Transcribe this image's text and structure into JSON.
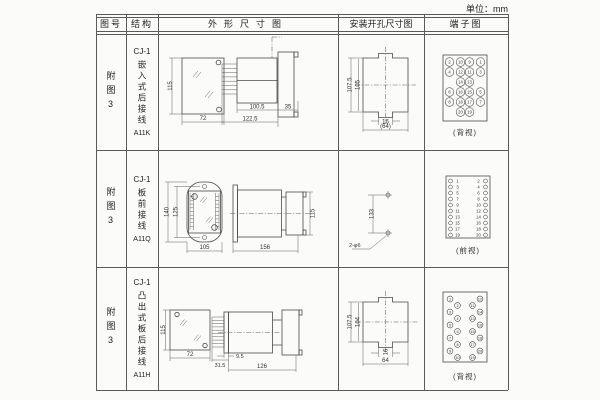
{
  "unit_note": "单位：mm",
  "colors": {
    "line": "#4a4a4a",
    "text": "#333333",
    "paper": "#fbfbf9"
  },
  "table": {
    "headers": [
      "图号",
      "结构",
      "外形尺寸图",
      "安装开孔尺寸图",
      "端子图"
    ],
    "rows": [
      {
        "fig_no": "附图3",
        "structure": {
          "model": "CJ-1",
          "mount": "嵌入式后接线",
          "code": "A11K"
        },
        "outline_dims": {
          "height": "115",
          "width": "72",
          "depth": "100.5",
          "total_depth": "122.5",
          "flange": "35"
        },
        "install_dims": {
          "outer": "107.5",
          "inner": "105",
          "notch": "16",
          "width": "(64)"
        },
        "terminal": {
          "view_label": "(背视)",
          "rows": [
            [
              "2",
              "10",
              "9",
              "1"
            ],
            [
              "4",
              "12",
              "11",
              "3"
            ],
            [
              "",
              "14",
              "13",
              ""
            ],
            [
              "6",
              "16",
              "15",
              "5"
            ],
            [
              "8",
              "18",
              "17",
              "7"
            ],
            [
              "",
              "20",
              "19",
              ""
            ]
          ]
        }
      },
      {
        "fig_no": "附图3",
        "structure": {
          "model": "CJ-1",
          "mount": "板前接线",
          "code": "A11Q"
        },
        "outline_dims": {
          "height": "140",
          "hole_span": "125",
          "width": "105",
          "length": "156",
          "rear_height": "115"
        },
        "install_dims": {
          "spacing": "133",
          "holes": "2-φ6"
        },
        "terminal": {
          "view_label": "(前视)",
          "left": [
            "1",
            "3",
            "5",
            "7",
            "9",
            "11",
            "13",
            "15",
            "17",
            "19"
          ],
          "right": [
            "2",
            "4",
            "6",
            "8",
            "10",
            "12",
            "14",
            "16",
            "18",
            "20"
          ]
        }
      },
      {
        "fig_no": "附图3",
        "structure": {
          "model": "CJ-1",
          "mount": "凸出式板后接线",
          "code": "A11H"
        },
        "outline_dims": {
          "height": "115",
          "width": "72",
          "fins_depth": "31.5",
          "plate": "9.5",
          "length": "126"
        },
        "install_dims": {
          "outer": "107.5",
          "inner": "104",
          "notch": "16",
          "width": "64"
        },
        "terminal": {
          "view_label": "(背视)",
          "left_outer": [
            "1",
            "3",
            "5",
            "7",
            "9"
          ],
          "left_inner": [
            "2",
            "4",
            "6",
            "8",
            "10"
          ],
          "right_inner": [
            "11",
            "13",
            "15",
            "17",
            "19"
          ],
          "right_outer": [
            "12",
            "14",
            "16",
            "18",
            "20"
          ]
        }
      }
    ]
  }
}
